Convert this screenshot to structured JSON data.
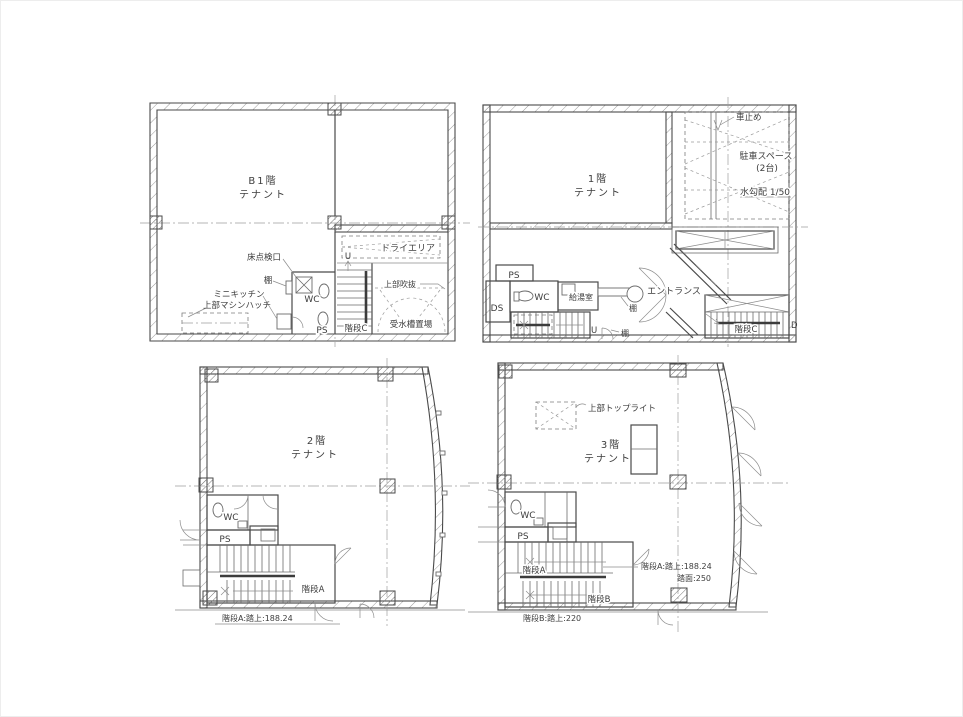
{
  "drawing": {
    "type": "architectural-floor-plans",
    "background": "#ffffff",
    "line_color": "#4a4a4a",
    "text_color": "#3d3d3d",
    "sheet_size": "963x717"
  },
  "plans": {
    "b1": {
      "room": {
        "line1": "B1階",
        "line2": "テナント"
      },
      "labels": {
        "floor_hatch": "床点検口",
        "shelf": "棚",
        "mini_kitchen": "ミニキッチン",
        "machine_hatch": "上部マシンハッチ",
        "wc": "WC",
        "ps": "PS",
        "stair_c": "階段C",
        "up": "U",
        "dry_area": "ドライエリア",
        "upper_void": "上部吹抜",
        "water_tank": "受水槽置場"
      }
    },
    "f1": {
      "room": {
        "line1": "1階",
        "line2": "テナント"
      },
      "labels": {
        "car_stop": "車止め",
        "parking": "駐車スペース",
        "parking_count": "(2台)",
        "slope": "水勾配 1/50",
        "ps": "PS",
        "ds": "DS",
        "wc": "WC",
        "kitchen": "給湯室",
        "shelf_a": "棚",
        "shelf_b": "棚",
        "entrance": "エントランス",
        "stair_c": "階段C",
        "up": "U",
        "down": "D"
      }
    },
    "f2": {
      "room": {
        "line1": "2階",
        "line2": "テナント"
      },
      "labels": {
        "wc": "WC",
        "ps": "PS",
        "stair_a": "階段A",
        "stair_note": "階段A:踏上:188.24"
      }
    },
    "f3": {
      "room": {
        "line1": "3階",
        "line2": "テナント"
      },
      "labels": {
        "toplight": "上部トップライト",
        "wc": "WC",
        "ps": "PS",
        "stair_a": "階段A",
        "stair_b": "階段B",
        "stair_a_note1": "階段A:踏上:188.24",
        "stair_a_note2": "踏面:250",
        "stair_b_note": "階段B:踏上:220"
      }
    }
  }
}
